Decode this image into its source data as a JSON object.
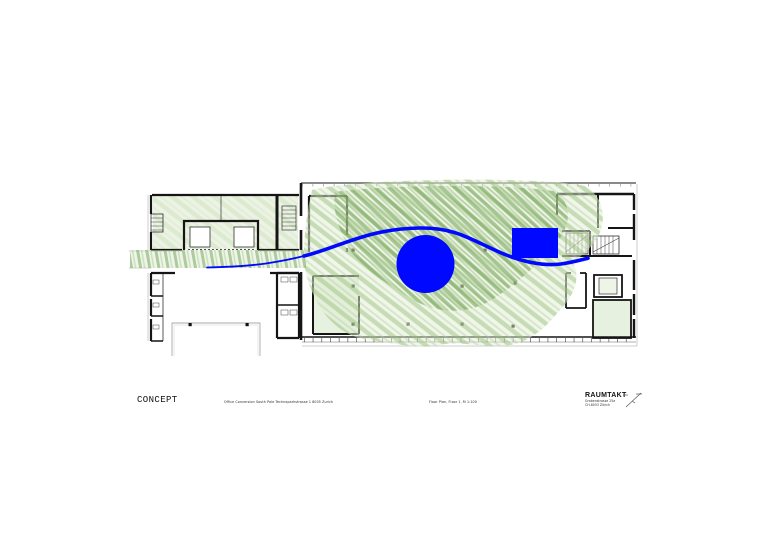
{
  "page": {
    "background": "#ffffff",
    "kind": "architectural concept floor plan sheet"
  },
  "plan": {
    "colors": {
      "concept_blue": "#0008ff",
      "hatch_green": "#6ea050",
      "hatch_green_light": "#93bd72",
      "wash_green": "#e2eed6",
      "wall_black": "#151515"
    },
    "concept_overlay": {
      "circle": "large solid blue circle in centre of main hall",
      "rectangle": "solid blue rectangle right of circle",
      "flow_line": "blue S-curved flow line from left corridor through hall to right wing"
    },
    "vegetation": "hand-drawn green pencil hatching over main hall and left corridor"
  },
  "title_block": {
    "title": "CONCEPT",
    "project_line": "Office Conversion South Pole  Technoparkstrasse 1  8005 Zurich",
    "drawing_line": "Floor Plan, Floor 1, M 1:100",
    "firm_name": "RAUMTAKT",
    "firm_address1": "Grabenstrasse 25a",
    "firm_address2": "CH-8053 Zürich"
  }
}
